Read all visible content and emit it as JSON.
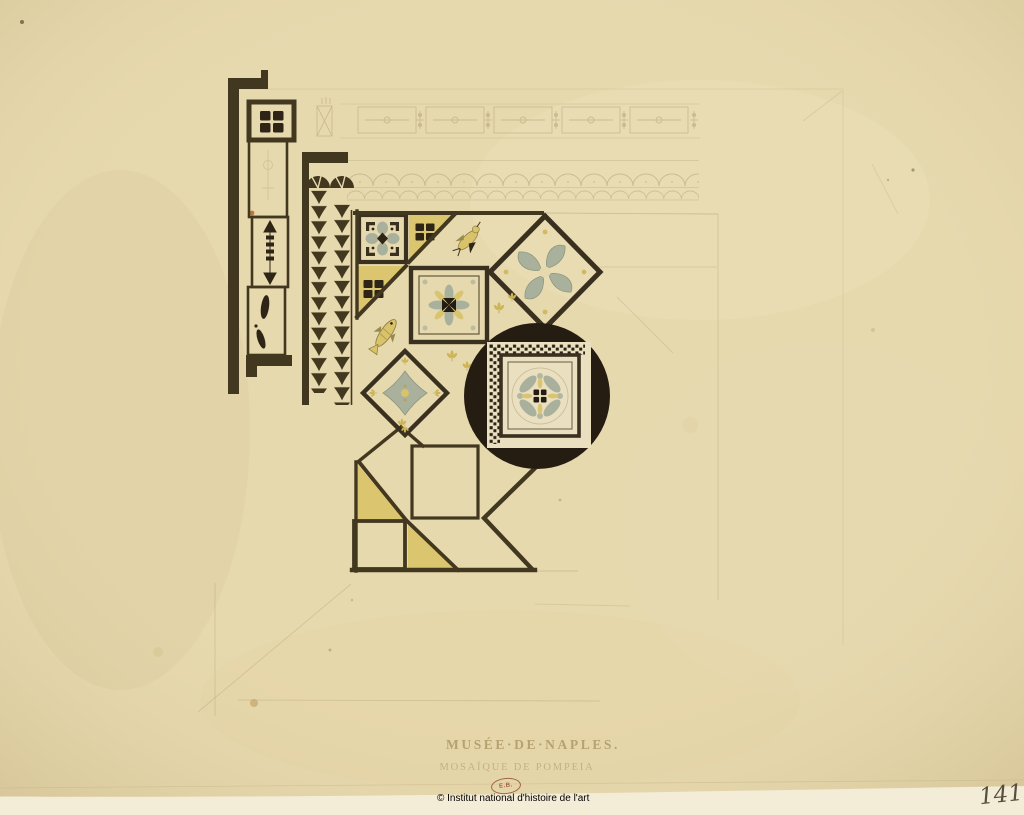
{
  "artwork": {
    "titles": {
      "line1": "MUSÉE·DE·NAPLES.",
      "line2": "MOSAÏQUE DE POMPEIA"
    },
    "stamp_text": "E.B.",
    "copyright": "© Institut national d'histoire de l'art",
    "page_number": "141",
    "palette": {
      "paper": "#e7d9ae",
      "backing_strip": "#f3ecd7",
      "ink_brown": "#42371f",
      "ink_black": "#261d12",
      "yellow_wash": "#dcc56f",
      "gray_green_wash": "#a9b19d",
      "pencil": "#b3a179",
      "stamp_red": "#92482e"
    }
  }
}
